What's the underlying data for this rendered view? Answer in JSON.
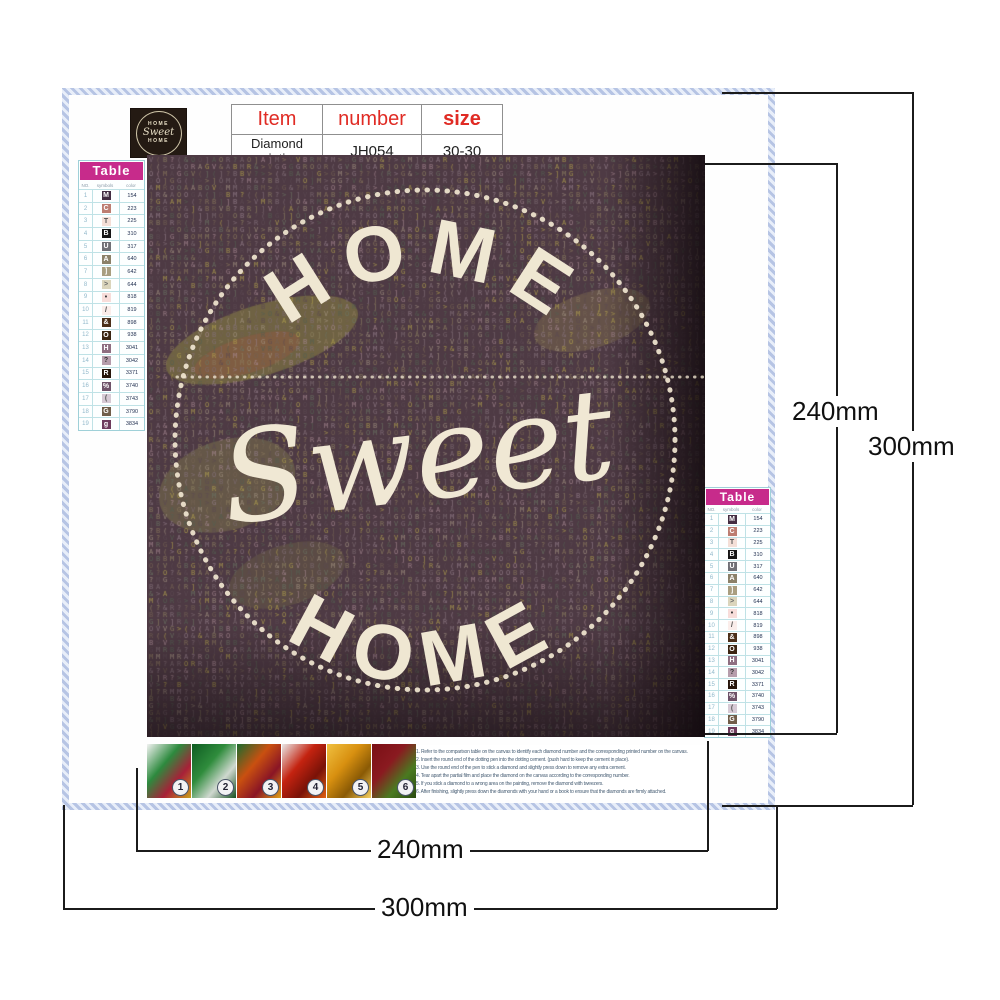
{
  "header": {
    "logo": {
      "top": "HOME",
      "middle": "Sweet",
      "bottom": "HOME"
    },
    "info_table": {
      "headers": [
        "Item",
        "number",
        "size"
      ],
      "values": [
        "Diamond painting",
        "JH054",
        "30-30"
      ],
      "header_color": "#e02b24"
    }
  },
  "color_table": {
    "title": "Table",
    "title_bg": "#c72b8b",
    "columns": [
      "NO.",
      "symbols",
      "color"
    ],
    "rows": [
      {
        "no": "1",
        "symbol": "M",
        "code": "154",
        "bg": "#432d42",
        "fg": "#ffffff"
      },
      {
        "no": "2",
        "symbol": "C",
        "code": "223",
        "bg": "#bd7e72",
        "fg": "#ffffff"
      },
      {
        "no": "3",
        "symbol": "T",
        "code": "225",
        "bg": "#f4dfd7",
        "fg": "#555555"
      },
      {
        "no": "4",
        "symbol": "B",
        "code": "310",
        "bg": "#151515",
        "fg": "#ffffff"
      },
      {
        "no": "5",
        "symbol": "U",
        "code": "317",
        "bg": "#707076",
        "fg": "#ffffff"
      },
      {
        "no": "6",
        "symbol": "A",
        "code": "640",
        "bg": "#8b8169",
        "fg": "#ffffff"
      },
      {
        "no": "7",
        "symbol": "]",
        "code": "642",
        "bg": "#a99e80",
        "fg": "#ffffff"
      },
      {
        "no": "8",
        "symbol": ">",
        "code": "644",
        "bg": "#dbd5bc",
        "fg": "#666666"
      },
      {
        "no": "9",
        "symbol": "•",
        "code": "818",
        "bg": "#f8ddda",
        "fg": "#333333"
      },
      {
        "no": "10",
        "symbol": "/",
        "code": "819",
        "bg": "#faedea",
        "fg": "#444444"
      },
      {
        "no": "11",
        "symbol": "&",
        "code": "898",
        "bg": "#4b2f19",
        "fg": "#ffffff"
      },
      {
        "no": "12",
        "symbol": "O",
        "code": "938",
        "bg": "#3b2511",
        "fg": "#ffffff"
      },
      {
        "no": "13",
        "symbol": "H",
        "code": "3041",
        "bg": "#8e6e81",
        "fg": "#ffffff"
      },
      {
        "no": "14",
        "symbol": "?",
        "code": "3042",
        "bg": "#b69dac",
        "fg": "#333333"
      },
      {
        "no": "15",
        "symbol": "R",
        "code": "3371",
        "bg": "#26150a",
        "fg": "#ffffff"
      },
      {
        "no": "16",
        "symbol": "%",
        "code": "3740",
        "bg": "#6e5369",
        "fg": "#ffffff"
      },
      {
        "no": "17",
        "symbol": "(",
        "code": "3743",
        "bg": "#d6cad5",
        "fg": "#555555"
      },
      {
        "no": "18",
        "symbol": "G",
        "code": "3790",
        "bg": "#705e4a",
        "fg": "#ffffff"
      },
      {
        "no": "19",
        "symbol": "g",
        "code": "3834",
        "bg": "#6e3b5d",
        "fg": "#ffffff"
      }
    ]
  },
  "painting": {
    "bg": "#4e3a44",
    "accent": "#ece2cc",
    "design": {
      "top_text": "HOME",
      "middle_text": "Sweet",
      "bottom_text": "HOME"
    },
    "texture": {
      "symbols": "OG&VMRB>]A?(",
      "palette": [
        "#7d6b72",
        "#8c7a5e",
        "#6b7464",
        "#95808c",
        "#5c4a52",
        "#a39482",
        "#746353",
        "#86737c",
        "#8f8463",
        "#b3a24f",
        "#a88a93",
        "#556052"
      ]
    }
  },
  "steps": {
    "items": [
      {
        "label": "1",
        "colors": [
          "#f2f2f2",
          "#2d8a3e",
          "#a82038",
          "#caa01a"
        ]
      },
      {
        "label": "2",
        "colors": [
          "#0e5c22",
          "#2f8c3c",
          "#cfd8cf",
          "#174f1f"
        ]
      },
      {
        "label": "3",
        "colors": [
          "#1a6b2e",
          "#c95010",
          "#8a1525",
          "#e0a015"
        ]
      },
      {
        "label": "4",
        "colors": [
          "#e8e8e8",
          "#c42310",
          "#7a1208",
          "#e06010"
        ]
      },
      {
        "label": "5",
        "colors": [
          "#f0c040",
          "#d89010",
          "#8a5a05",
          "#f5d060"
        ]
      },
      {
        "label": "6",
        "colors": [
          "#7a0f15",
          "#8a1a20",
          "#4a7a20",
          "#2a4a10"
        ]
      }
    ]
  },
  "instructions": {
    "lines": [
      "1. Refer to the comparison table on the canvas to identify each diamond number and the corresponding printed number on the canvas.",
      "2. Insert the round end of the dotting pen into the dotting cement. (push hard to keep the cement in place).",
      "3. Use the round end of the pen to stick a diamond and slightly press down to remove any extra cement.",
      "4. Tear apart the partial film and place the diamond on the canvas according to the corresponding number.",
      "5. If you stick a diamond to a wrong area on the painting, remove the diamond with tweezers.",
      "6. After finishing, slightly press down the diamonds with your hand or a book to ensure that the diamonds are firmly attached."
    ]
  },
  "dimensions": {
    "height_inner": "240mm",
    "height_outer": "300mm",
    "width_inner": "240mm",
    "width_outer": "300mm"
  }
}
